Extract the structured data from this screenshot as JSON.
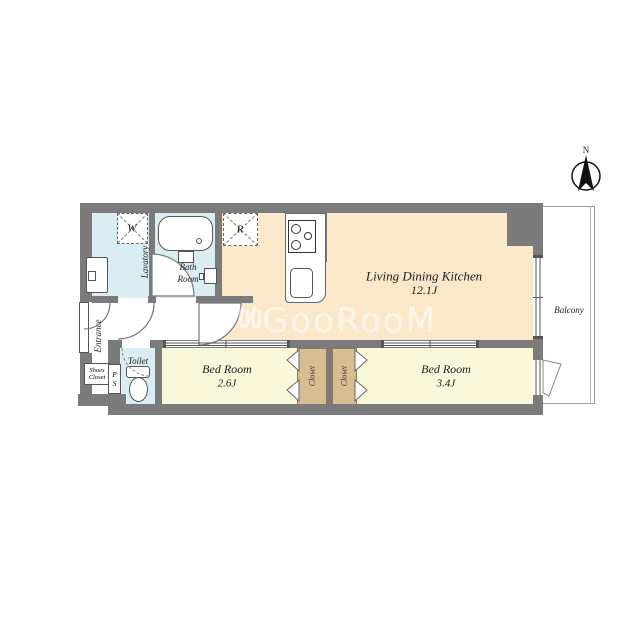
{
  "compass": {
    "north_label": "N"
  },
  "watermark": {
    "brand": "GooRooM"
  },
  "colors": {
    "wall": "#7b7b7b",
    "ldk_floor": "#fbe8cb",
    "bedroom_floor": "#f9f8da",
    "closet_floor": "#d8bd91",
    "wet_area_floor": "#d9edf3",
    "balcony_line": "#999999"
  },
  "rooms": {
    "ldk": {
      "name": "Living Dining Kitchen",
      "size": "12.1J"
    },
    "bedroom_small": {
      "name": "Bed Room",
      "size": "2.6J"
    },
    "bedroom_large": {
      "name": "Bed Room",
      "size": "3.4J"
    },
    "closet_left": {
      "name": "Closet"
    },
    "closet_right": {
      "name": "Closet"
    },
    "bath": {
      "line1": "Bath",
      "line2": "Room"
    },
    "lavatory": {
      "name": "Lavatory"
    },
    "toilet": {
      "name": "Toilet"
    },
    "entrance": {
      "name": "Entrance"
    },
    "shoes_closet": {
      "line1": "Shoes",
      "line2": "Closet"
    },
    "pipe_space": {
      "line1": "P",
      "line2": "S"
    },
    "balcony": {
      "name": "Balcony"
    }
  },
  "fixtures": {
    "washer_label": "W",
    "refrigerator_label": "R"
  }
}
